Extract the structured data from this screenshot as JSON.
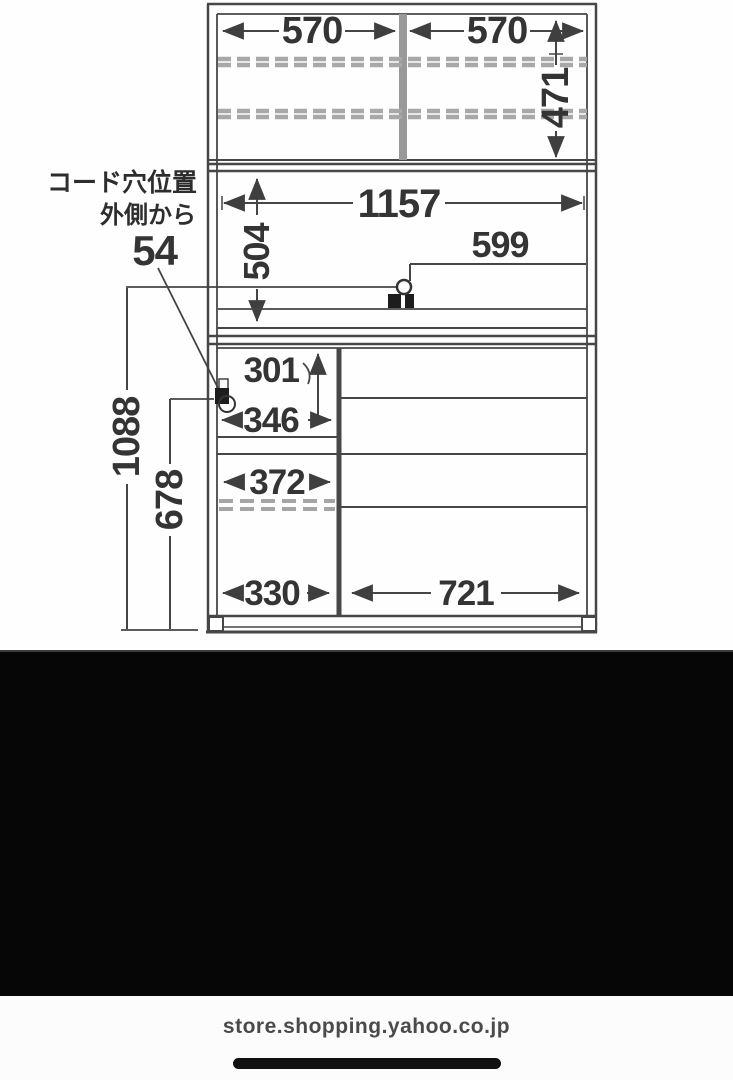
{
  "diagram": {
    "note": {
      "title": "コード穴位置",
      "subtitle": "外側から",
      "value": "54"
    },
    "dims": {
      "upper_left_width": "570",
      "upper_right_width": "570",
      "upper_inner_height": "471",
      "middle_inner_width": "1157",
      "middle_inner_height": "504",
      "counter_shelf_width": "599",
      "niche_height": "301",
      "niche_width": "346",
      "left_shelf_width": "372",
      "left_bottom_width": "330",
      "right_bottom_width": "721",
      "cord_hole_height_upper": "1088",
      "cord_hole_height_lower": "678"
    },
    "colors": {
      "line": "#474747",
      "dashed_line": "#a8a8a8",
      "text": "#343434",
      "divider_fill": "#999999",
      "hole_fill": "#1d1d1d"
    }
  },
  "black_band": {
    "color": "#060606"
  },
  "footer": {
    "url": "store.shopping.yahoo.co.jp",
    "background": "#fcfcfc",
    "text_color": "#4a4a4a",
    "home_indicator_color": "#111111"
  }
}
